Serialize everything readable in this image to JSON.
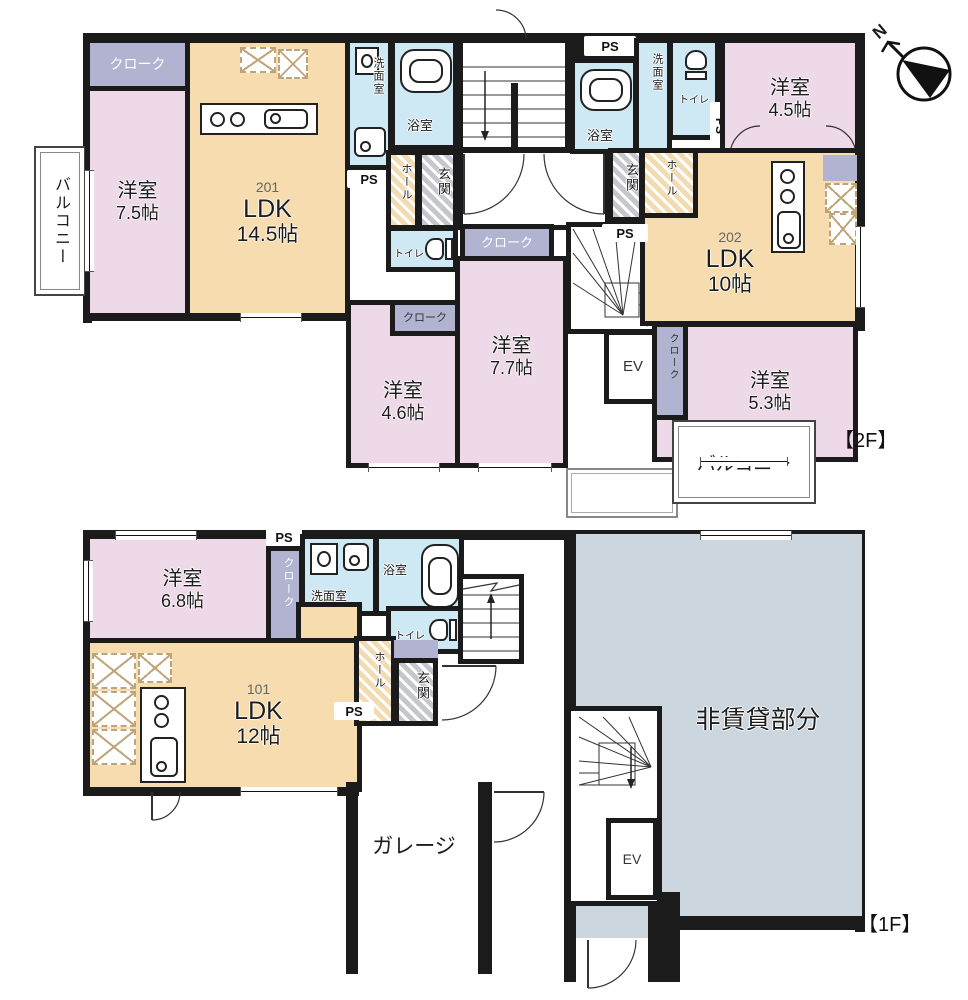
{
  "colors": {
    "wall": "#1b1b1b",
    "room_pink": "#eed9e9",
    "room_beige": "#f6dcae",
    "room_blue": "#cfe9f4",
    "room_lavender": "#b2b3d1",
    "entrance_gray": "#c9c9cf",
    "non_rental_gray": "#ccd6de"
  },
  "compass": {
    "label": "N"
  },
  "floor2": {
    "tag": "【2F】",
    "balcony_left": "バルコニー",
    "balcony_right": "バルコニー",
    "unit201": {
      "number": "201",
      "ldk": "LDK",
      "ldk_size": "14.5帖",
      "bedroom": "洋室",
      "bedroom_size": "7.5帖",
      "cloak": "クローク",
      "washroom": "洗面室",
      "bath": "浴室",
      "toilet": "トイレ",
      "hall": "ホール",
      "entrance": "玄関",
      "ps": "PS"
    },
    "center": {
      "cloak": "クローク",
      "ev": "EV"
    },
    "room46": {
      "name": "洋室",
      "size": "4.6帖",
      "cloak": "クローク"
    },
    "room77": {
      "name": "洋室",
      "size": "7.7帖"
    },
    "unit202": {
      "number": "202",
      "ldk": "LDK",
      "ldk_size": "10帖",
      "bedroom45": "洋室",
      "bedroom45_size": "4.5帖",
      "bedroom53": "洋室",
      "bedroom53_size": "5.3帖",
      "cloak53": "クローク",
      "washroom": "洗面室",
      "bath": "浴室",
      "toilet": "トイレ",
      "hall": "ホール",
      "entrance": "玄関",
      "ps_top": "PS",
      "ps_side": "PS",
      "ps_bottom": "PS"
    }
  },
  "floor1": {
    "tag": "【1F】",
    "unit101": {
      "number": "101",
      "ldk": "LDK",
      "ldk_size": "12帖",
      "bedroom": "洋室",
      "bedroom_size": "6.8帖",
      "cloak": "クローク",
      "washroom": "洗面室",
      "bath": "浴室",
      "toilet": "トイレ",
      "hall": "ホール",
      "entrance": "玄関",
      "ps_top": "PS",
      "ps_mid": "PS"
    },
    "garage": "ガレージ",
    "non_rental": "非賃貸部分",
    "ev": "EV"
  }
}
